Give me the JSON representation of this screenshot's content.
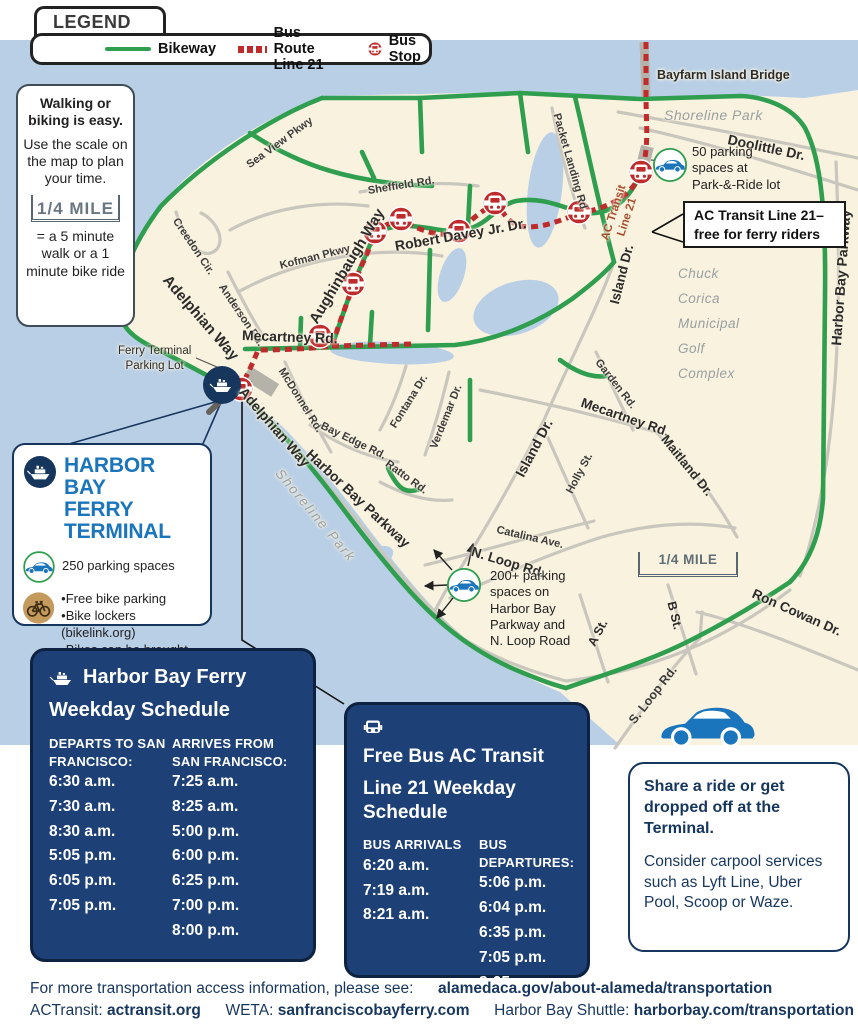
{
  "colors": {
    "bikeway": "#2f9e4f",
    "bus_route": "#bf2b2b",
    "navy_box": "#1d4077",
    "accent_blue": "#1b75bc",
    "water": "#b9cfe6",
    "land": "#f9f2df"
  },
  "legend": {
    "title": "LEGEND",
    "bikeway": "Bikeway",
    "bus_route": "Bus Route Line 21",
    "bus_stop": "Bus Stop"
  },
  "walking_box": {
    "title": "Walking or biking is easy.",
    "body": "Use the scale on the map to plan your time.",
    "scale_label": "1/4 MILE",
    "footnote": "= a 5 minute walk or a 1 minute bike ride"
  },
  "map": {
    "bayfarm_bridge": "Bayfarm Island Bridge",
    "shoreline_park_north": "Shoreline Park",
    "doolittle_dr": "Doolittle Dr.",
    "parking_50": "50 parking\nspaces at\nPark-&-Ride lot",
    "ac_transit_route": "AC Transit\nLine 21",
    "ac_callout_line1": "AC Transit Line 21–",
    "ac_callout_line2": "free for ferry riders",
    "harbor_bay_pkwy_east": "Harbor Bay Parkway",
    "golf": "Chuck\nCorica\nMunicipal\nGolf\nComplex",
    "sea_view": "Sea View Pkwy",
    "sheffield": "Sheffield Rd.",
    "packet_landing": "Packet Landing Rd",
    "creedon": "Creedon Cir.",
    "kofman": "Kofman Pkwy",
    "anderson": "Anderson Rd.",
    "adelphian_upper": "Adelphian Way",
    "aughinbaugh": "Aughinbaugh Way",
    "robert_davey": "Robert Davey Jr. Dr.",
    "island_dr_north": "Island Dr.",
    "mecartney_west": "Mecartney Rd.",
    "mecartney_east": "Mecartney Rd.",
    "garden_rd": "Garden Rd.",
    "maitland": "Maitland Dr.",
    "holly": "Holly St.",
    "island_dr_central": "Island Dr.",
    "mcdonnel": "McDonnel Rd.",
    "bay_edge": "Bay Edge Rd.",
    "fontana": "Fontana Dr.",
    "verdemar": "Verdemar Dr.",
    "ratto": "Ratto Rd.",
    "catalina": "Catalina Ave.",
    "n_loop": "N. Loop Rd.",
    "parking_200": "200+ parking\nspaces on\nHarbor Bay\nParkway and\nN. Loop Road",
    "scale_label": "1/4 MILE",
    "a_st": "A St.",
    "b_st": "B St.",
    "ron_cowan": "Ron Cowan Dr.",
    "s_loop": "S. Loop Rd.",
    "ferry_parking": "Ferry Terminal\nParking Lot",
    "shoreline_park_south": "Shoreline Park",
    "harbor_bay_pkwy_south": "Harbor Bay Parkway",
    "adelphian_lower": "Adelphian Way"
  },
  "terminal_box": {
    "title_line1": "HARBOR BAY",
    "title_line2": "FERRY TERMINAL",
    "parking": "250 parking spaces",
    "bike_items": [
      "•Free bike parking",
      "•Bike lockers (bikelink.org)",
      "•Bikes can be brought on",
      "the ferry"
    ]
  },
  "ferry_schedule": {
    "title_line1": "Harbor Bay Ferry",
    "title_line2": "Weekday Schedule",
    "departs_header": "DEPARTS TO SAN FRANCISCO:",
    "arrives_header": "ARRIVES FROM SAN FRANCISCO:",
    "departs": [
      "6:30 a.m.",
      "7:30 a.m.",
      "8:30 a.m.",
      "5:05 p.m.",
      "6:05 p.m.",
      "7:05 p.m."
    ],
    "arrives": [
      "7:25 a.m.",
      "8:25 a.m.",
      "5:00 p.m.",
      "6:00 p.m.",
      "6:25 p.m.",
      "7:00 p.m.",
      "8:00 p.m."
    ]
  },
  "bus_schedule": {
    "title_line1": "Free Bus AC Transit",
    "title_line2": "Line 21 Weekday Schedule",
    "arrivals_header": "BUS ARRIVALS",
    "departures_header": "BUS DEPARTURES:",
    "arrivals": [
      "6:20 a.m.",
      "7:19 a.m.",
      "8:21 a.m."
    ],
    "departures": [
      "5:06 p.m.",
      "6:04 p.m.",
      "6:35 p.m.",
      "7:05 p.m.",
      "8:05p.m."
    ]
  },
  "rideshare_box": {
    "title": "Share a ride or get dropped off at the Terminal.",
    "body": "Consider carpool services such as Lyft Line, Uber Pool, Scoop or Waze."
  },
  "footer": {
    "line1_text": "For more transportation access information, please see:",
    "line1_link": "alamedaca.gov/about-alameda/transportation",
    "actransit_label": "ACTransit:",
    "actransit_link": "actransit.org",
    "weta_label": "WETA:",
    "weta_link": "sanfranciscobayferry.com",
    "shuttle_label": "Harbor Bay Shuttle:",
    "shuttle_link": "harborbay.com/transportation"
  }
}
